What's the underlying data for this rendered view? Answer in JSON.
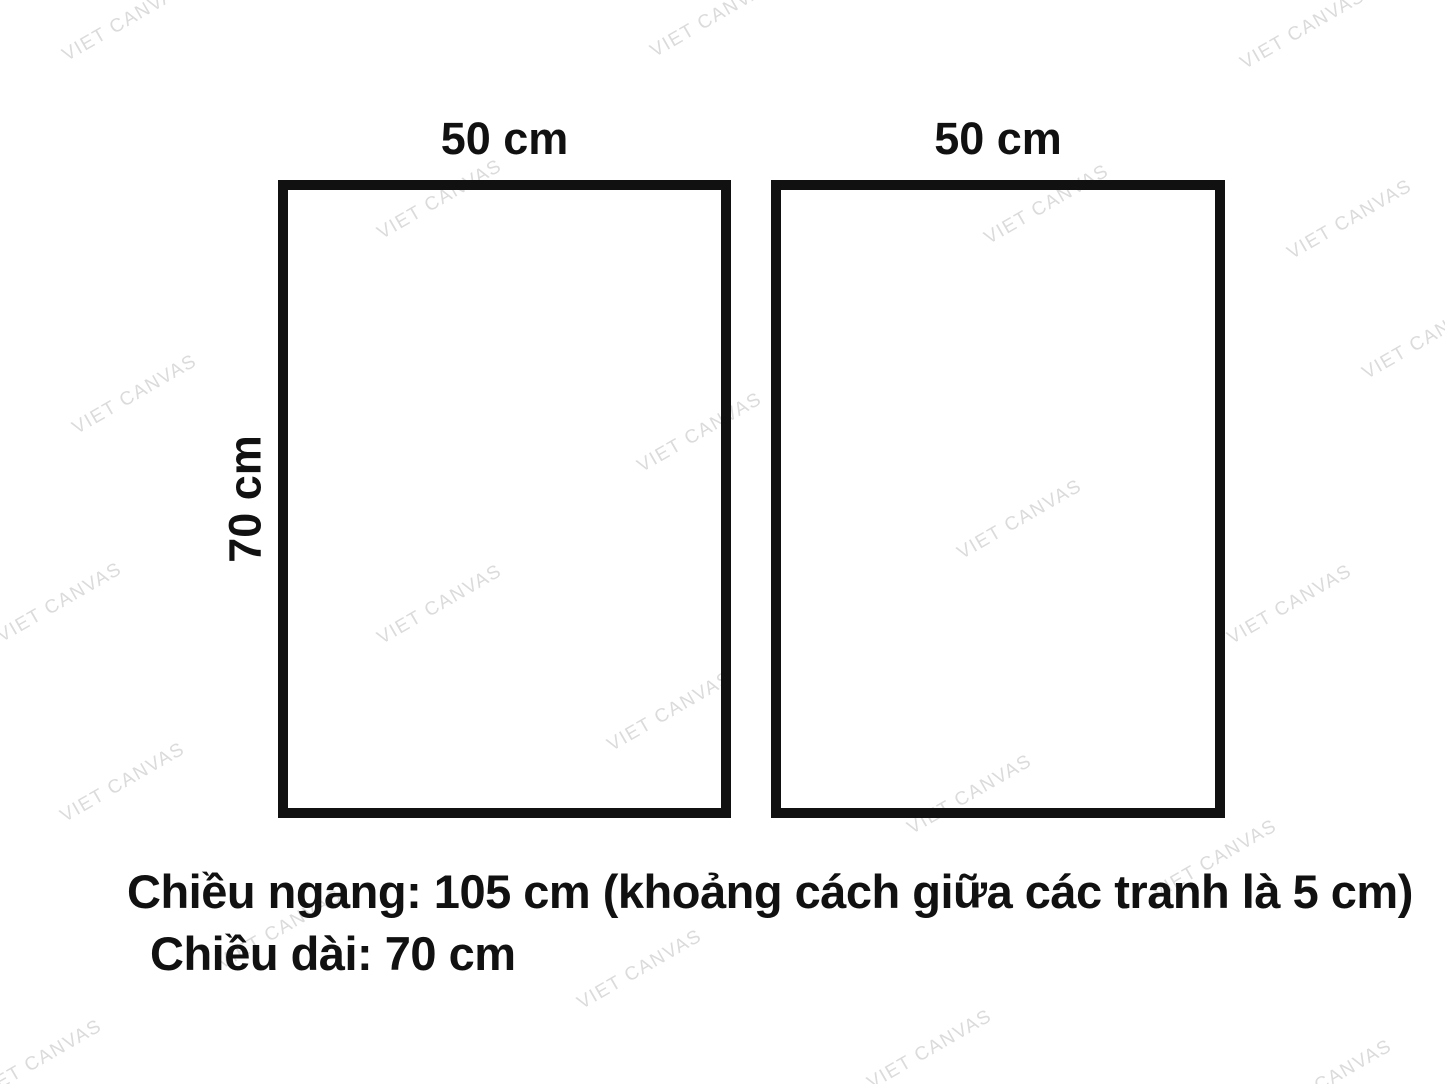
{
  "diagram": {
    "panels": [
      {
        "width_label": "50 cm"
      },
      {
        "width_label": "50 cm"
      }
    ],
    "height_label": "70 cm",
    "ink_color": "#111111"
  },
  "caption": {
    "line1": "Chiều ngang: 105 cm (khoảng cách giữa các tranh là 5 cm)",
    "line2": "Chiều dài: 70 cm"
  },
  "watermark": {
    "text": "VIET CANVAS",
    "color": "#dbdbdb",
    "angle_deg": -30,
    "positions": [
      {
        "x": 125,
        "y": 22
      },
      {
        "x": 713,
        "y": 18
      },
      {
        "x": 1303,
        "y": 30
      },
      {
        "x": 440,
        "y": 200
      },
      {
        "x": 1047,
        "y": 205
      },
      {
        "x": 1350,
        "y": 220
      },
      {
        "x": 135,
        "y": 395
      },
      {
        "x": 700,
        "y": 433
      },
      {
        "x": 1425,
        "y": 340
      },
      {
        "x": 1020,
        "y": 520
      },
      {
        "x": 440,
        "y": 605
      },
      {
        "x": 60,
        "y": 603
      },
      {
        "x": 1290,
        "y": 605
      },
      {
        "x": 670,
        "y": 712
      },
      {
        "x": 123,
        "y": 783
      },
      {
        "x": 970,
        "y": 795
      },
      {
        "x": 1215,
        "y": 860
      },
      {
        "x": 280,
        "y": 930
      },
      {
        "x": 640,
        "y": 970
      },
      {
        "x": 40,
        "y": 1060
      },
      {
        "x": 930,
        "y": 1050
      },
      {
        "x": 1330,
        "y": 1080
      }
    ]
  }
}
